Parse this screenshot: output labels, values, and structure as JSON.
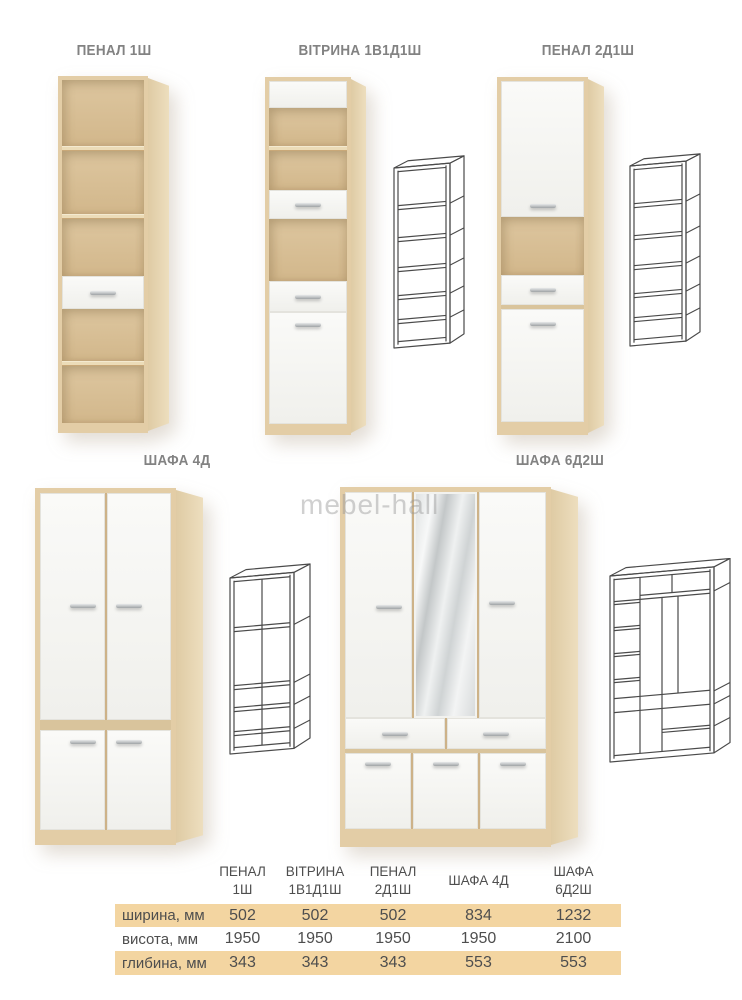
{
  "watermark": {
    "text": "mebel-hall"
  },
  "products": [
    {
      "id": "penal-1sh",
      "label": "ПЕНАЛ 1Ш"
    },
    {
      "id": "vitrina-1v1d1sh",
      "label": "ВІТРИНА 1В1Д1Ш"
    },
    {
      "id": "penal-2d1sh",
      "label": "ПЕНАЛ 2Д1Ш"
    },
    {
      "id": "shafa-4d",
      "label": "ШАФА 4Д"
    },
    {
      "id": "shafa-6d2sh",
      "label": "ШАФА 6Д2Ш"
    }
  ],
  "dimensions_table": {
    "header_lines": [
      [
        "ПЕНАЛ",
        "1Ш"
      ],
      [
        "ВІТРИНА",
        "1В1Д1Ш"
      ],
      [
        "ПЕНАЛ",
        "2Д1Ш"
      ],
      [
        "ШАФА 4Д",
        ""
      ],
      [
        "ШАФА",
        "6Д2Ш"
      ]
    ],
    "rows": [
      {
        "label": "ширина, мм",
        "values": [
          "502",
          "502",
          "502",
          "834",
          "1232"
        ]
      },
      {
        "label": "висота, мм",
        "values": [
          "1950",
          "1950",
          "1950",
          "1950",
          "2100"
        ]
      },
      {
        "label": "глибина, мм",
        "values": [
          "343",
          "343",
          "343",
          "553",
          "553"
        ]
      }
    ]
  },
  "colors": {
    "wood_frame": "#e3cda6",
    "wood_interior": "#d8bf97",
    "wood_side": "#e7d6b4",
    "door_white": "#f7f7f4",
    "handle_silver": "#a8abad",
    "table_highlight": "#f3d5a1",
    "table_text": "#4e4e4e",
    "label_text": "#828282",
    "wireframe_stroke": "#4a4a4a"
  }
}
